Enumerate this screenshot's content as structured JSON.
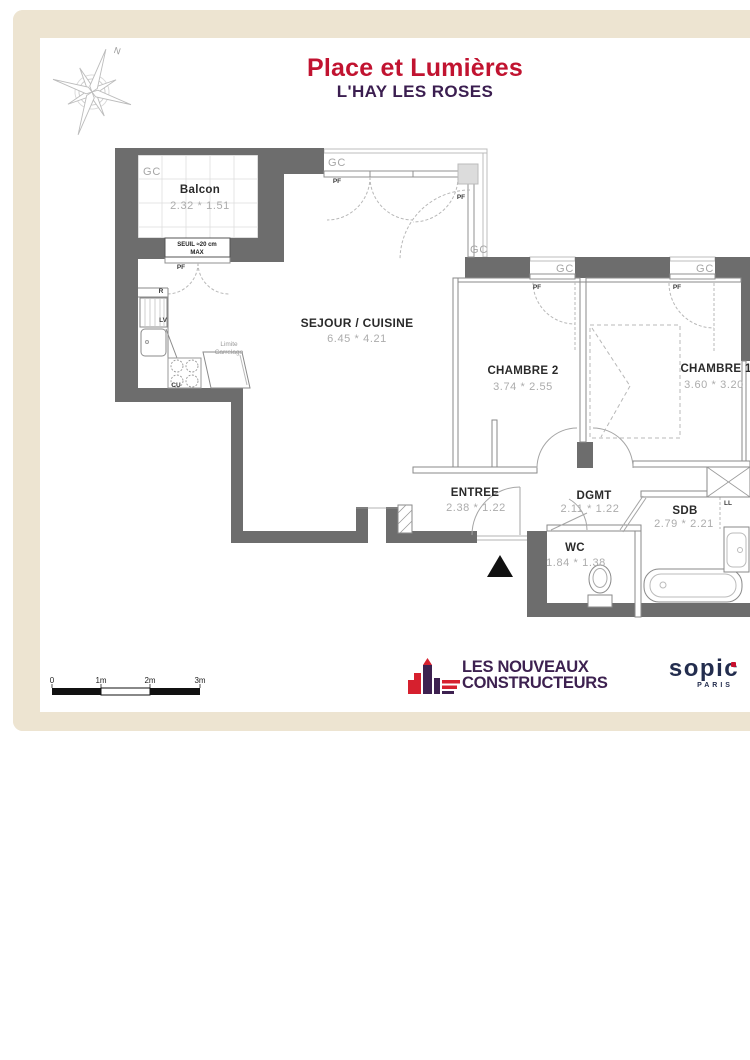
{
  "header": {
    "title": "Place et Lumières",
    "subtitle": "L'HAY LES ROSES"
  },
  "compass": {
    "north": "N"
  },
  "rooms": {
    "balcon": {
      "name": "Balcon",
      "dims": "2.32 * 1.51"
    },
    "sejour": {
      "name": "SEJOUR / CUISINE",
      "dims": "6.45 * 4.21"
    },
    "chambre2": {
      "name": "CHAMBRE 2",
      "dims": "3.74 * 2.55"
    },
    "chambre1": {
      "name": "CHAMBRE 1",
      "dims": "3.60 * 3.20"
    },
    "entree": {
      "name": "ENTREE",
      "dims": "2.38 * 1.22"
    },
    "dgmt": {
      "name": "DGMT",
      "dims": "2.11 * 1.22"
    },
    "wc": {
      "name": "WC",
      "dims": "1.84 * 1.38"
    },
    "sdb": {
      "name": "SDB",
      "dims": "2.79 * 2.21"
    }
  },
  "labels": {
    "gc": "GC",
    "pf": "PF",
    "seuil_line1": "SEUIL ≈20 cm",
    "seuil_line2": "MAX",
    "limite_line1": "Limite",
    "limite_line2": "Carrelage",
    "fridge": "R",
    "dishwasher": "LV",
    "cooktop": "CU",
    "washer": "LL"
  },
  "scalebar": {
    "labels": [
      "0",
      "1m",
      "2m",
      "3m"
    ]
  },
  "footer": {
    "lnc_line1": "LES NOUVEAUX",
    "lnc_line2": "CONSTRUCTEURS",
    "sopic_name": "sopic",
    "sopic_city": "PARIS"
  },
  "colors": {
    "title_red": "#c11330",
    "subtitle_purple": "#3b1e50",
    "wall_gray": "#6d6d6d",
    "frame_beige": "#ede4d1",
    "lnc_red": "#d6202e",
    "sopic_navy": "#232d4e"
  }
}
